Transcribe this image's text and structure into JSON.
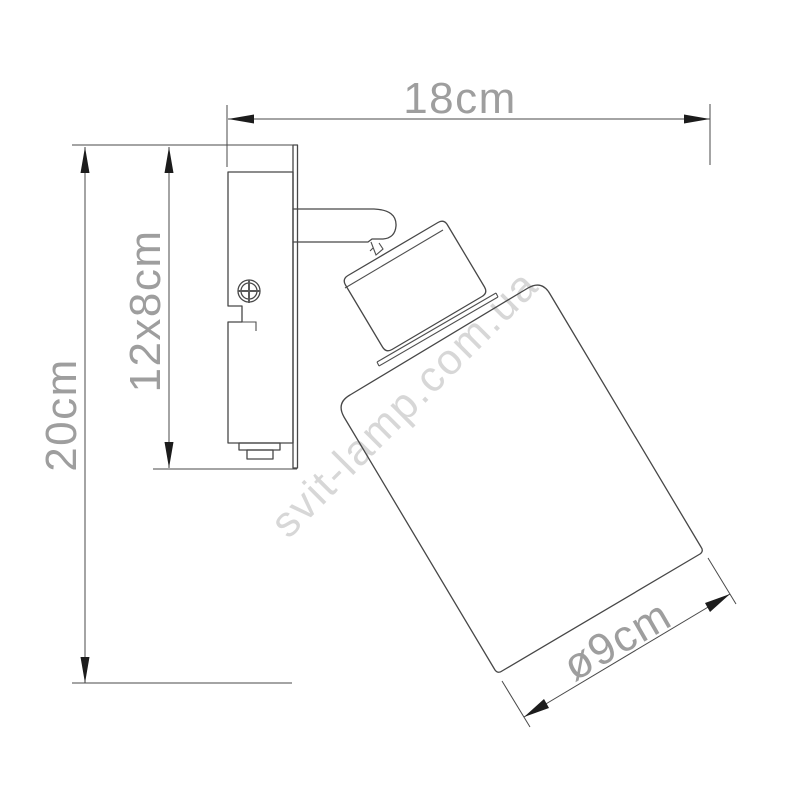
{
  "drawing": {
    "title": "wall-spot-lamp-dimension-drawing",
    "labels": {
      "width": "18cm",
      "height": "20cm",
      "backplate": "12x8cm",
      "shade_diameter": "ø9cm"
    },
    "watermark": "svit-lamp.com.ua",
    "colors": {
      "background": "#ffffff",
      "outline": "#474747",
      "dimension_line": "#4a4a4a",
      "arrow": "#1c1c1c",
      "dimension_text": "#9e9e9e",
      "watermark_text": "#d7d7d7"
    }
  }
}
